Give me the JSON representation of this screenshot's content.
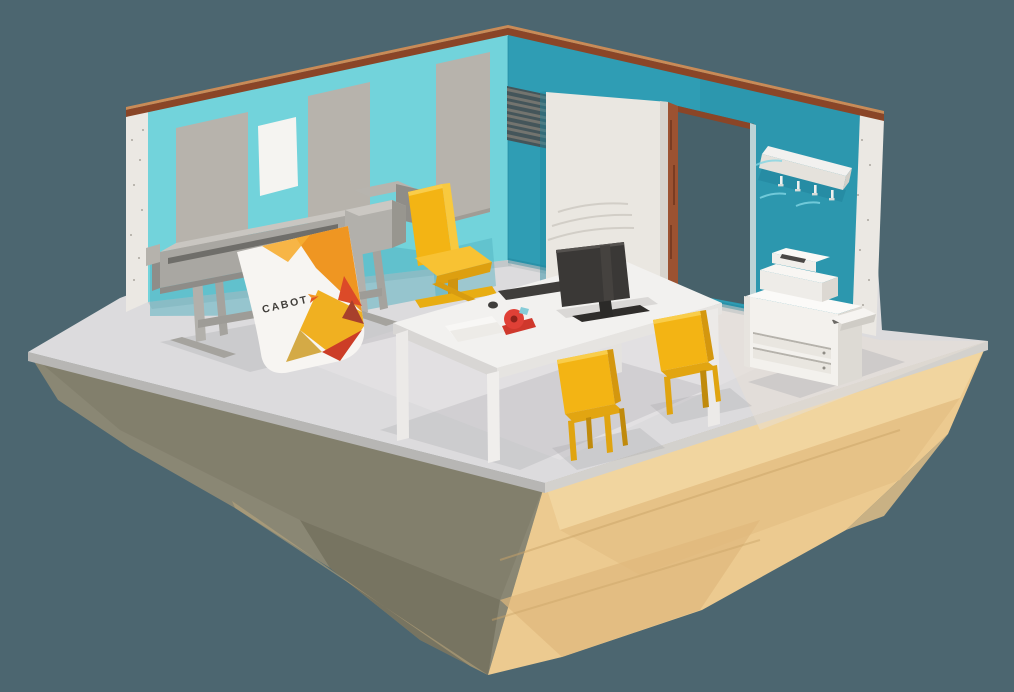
{
  "scene": {
    "description": "Low-poly 3D isometric illustration of a print-room office on a floating island",
    "background_color": "#4c6670"
  },
  "branding": {
    "logo_text": "CABOT",
    "logo_text_color": "#413e3a",
    "logo_chevron_color": "#ef7d22"
  },
  "palette": {
    "background": "#4c6670",
    "floor_gray": "#dcdbdd",
    "island_sand": "#ecca90",
    "island_shadow_side": "#8a8774",
    "wall_left": "#72d3db",
    "wall_back": "#2f9db4",
    "wall_cross_section": "#ebe8e3",
    "wall_top_copper": "#8a4527",
    "panel_gray": "#b7b3ac",
    "poster_white": "#f5f4f1",
    "door_white": "#eae7e1",
    "doorway_frame_rust": "#9c5231",
    "plotter_gray": "#a9a7a2",
    "banner_white": "#f7f5f2",
    "banner_orange": "#ef9622",
    "banner_yellow": "#f0b021",
    "banner_red": "#cc3d27",
    "chair_yellow": "#f3b414",
    "furniture_white": "#f2f1ef",
    "copier_white": "#f3f1ed",
    "monitor_dark": "#3a3836",
    "tape_red": "#e04036"
  },
  "objects": {
    "items": [
      "floating-island",
      "print-room",
      "wide-format-plotter",
      "printed-banner",
      "office-chair",
      "desk",
      "monitor",
      "keyboard",
      "mouse",
      "tape-dispenser",
      "paper-sheets",
      "guest-chairs",
      "multifunction-copier",
      "coat-rack",
      "wall-vent",
      "sliding-door",
      "doorway",
      "wall-panels",
      "poster"
    ]
  }
}
